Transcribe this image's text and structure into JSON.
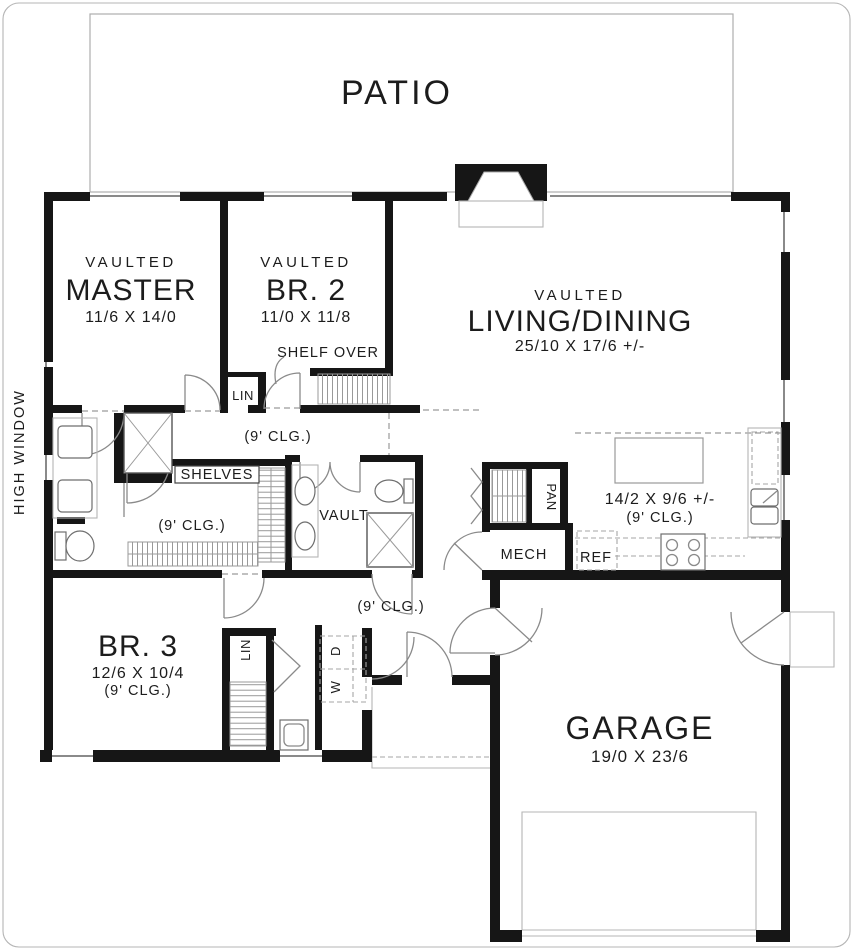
{
  "plan": {
    "patio_label": "PATIO",
    "rooms": {
      "master": {
        "tag": "VAULTED",
        "name": "MASTER",
        "dims": "11/6 X 14/0"
      },
      "br2": {
        "tag": "VAULTED",
        "name": "BR. 2",
        "dims": "11/0 X 11/8"
      },
      "living": {
        "tag": "VAULTED",
        "name": "LIVING/DINING",
        "dims": "25/10 X 17/6 +/-"
      },
      "kitchen": {
        "dims": "14/2 X 9/6 +/-",
        "ceiling": "(9' CLG.)"
      },
      "br3": {
        "name": "BR. 3",
        "dims": "12/6 X 10/4",
        "ceiling": "(9' CLG.)"
      },
      "garage": {
        "name": "GARAGE",
        "dims": "19/0 X 23/6"
      }
    },
    "annotations": {
      "shelf_over": "SHELF OVER",
      "lin_upper": "LIN",
      "lin_lower": "LIN",
      "shelves": "SHELVES",
      "vault": "VAULT",
      "pantry": "PAN",
      "mech": "MECH",
      "ref": "REF",
      "washer": "W",
      "dryer": "D",
      "high_window": "HIGH WINDOW",
      "hall_ceiling": "(9' CLG.)",
      "closet_ceiling": "(9' CLG.)",
      "foyer_ceiling": "(9' CLG.)"
    },
    "colors": {
      "wall": "#161616",
      "thin_line": "#8a8a8a",
      "text": "#1c1c1c"
    }
  }
}
